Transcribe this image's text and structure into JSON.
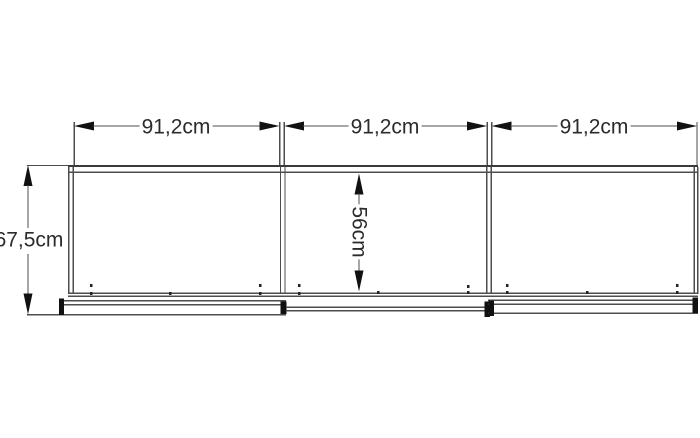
{
  "drawing": {
    "type": "furniture-dimension-diagram",
    "section_width_labels": [
      "91,2cm",
      "91,2cm",
      "91,2cm"
    ],
    "total_height_label": "67,5cm",
    "inner_height_label": "56cm"
  },
  "colors": {
    "background": "#ffffff",
    "line": "#4d4d4d",
    "dark_line": "#3a3a3a",
    "arrow_and_caps": "#111111",
    "text": "#2b2b2b"
  }
}
